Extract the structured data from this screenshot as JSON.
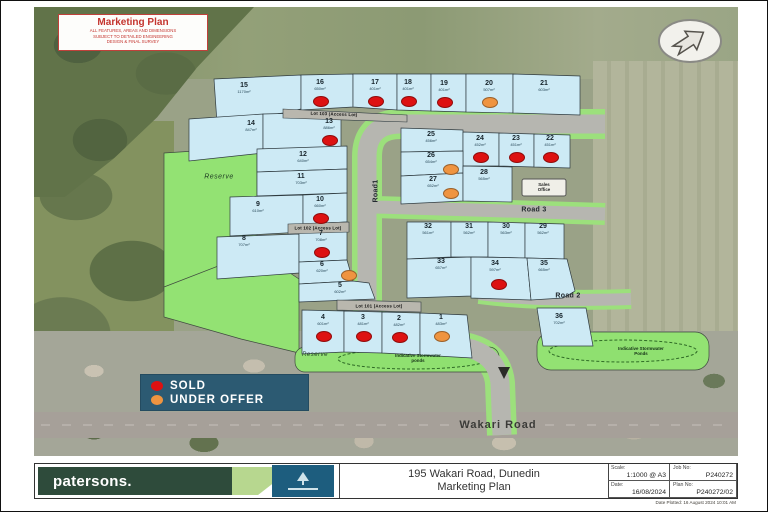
{
  "disclaimer": {
    "title": "Marketing Plan",
    "lines": [
      "ALL FEATURES, AREAS AND DIMENSIONS",
      "SUBJECT TO DETAILED ENGINEERING",
      "DESIGN & FINAL SURVEY"
    ]
  },
  "legend": {
    "items": [
      {
        "label": "SOLD",
        "status": "sold",
        "color": "#dd1111"
      },
      {
        "label": "UNDER OFFER",
        "status": "under offer",
        "color": "#ef9440"
      }
    ],
    "background": "#2c5a72"
  },
  "roads": {
    "road1": "Road1",
    "road2": "Road 2",
    "road3": "Road 3",
    "wakari": "Wakari Road"
  },
  "annotations": {
    "reserve_west": "Reserve",
    "reserve_south": "Reserve",
    "sales_office": [
      "Sales",
      "Office"
    ],
    "stormwater_south": [
      "Indicative Stormwater",
      "ponds"
    ],
    "stormwater_east": [
      "Indicative Stormwater",
      "Ponds"
    ],
    "access_lots": {
      "lot101": "Lot 101 (Access Lot)",
      "lot102": "Lot 102 (Access Lot)",
      "lot103": "Lot 103 (Access Lot)"
    }
  },
  "lots": [
    {
      "id": "1",
      "area": "483m²",
      "status": "under offer"
    },
    {
      "id": "2",
      "area": "482m²",
      "status": "sold"
    },
    {
      "id": "3",
      "area": "481m²",
      "status": "sold"
    },
    {
      "id": "4",
      "area": "601m²",
      "status": "sold"
    },
    {
      "id": "5",
      "area": "602m²",
      "status": "available"
    },
    {
      "id": "6",
      "area": "620m²",
      "status": "under offer"
    },
    {
      "id": "7",
      "area": "708m²",
      "status": "sold"
    },
    {
      "id": "8",
      "area": "707m²",
      "status": "available"
    },
    {
      "id": "9",
      "area": "610m²",
      "status": "available"
    },
    {
      "id": "10",
      "area": "660m²",
      "status": "sold"
    },
    {
      "id": "11",
      "area": "703m²",
      "status": "available"
    },
    {
      "id": "12",
      "area": "640m²",
      "status": "available"
    },
    {
      "id": "13",
      "area": "886m²",
      "status": "sold"
    },
    {
      "id": "14",
      "area": "847m²",
      "status": "available"
    },
    {
      "id": "15",
      "area": "1170m²",
      "status": "available"
    },
    {
      "id": "16",
      "area": "650m²",
      "status": "sold"
    },
    {
      "id": "17",
      "area": "401m²",
      "status": "sold"
    },
    {
      "id": "18",
      "area": "401m²",
      "status": "sold"
    },
    {
      "id": "19",
      "area": "401m²",
      "status": "sold"
    },
    {
      "id": "20",
      "area": "507m²",
      "status": "under offer"
    },
    {
      "id": "21",
      "area": "603m²",
      "status": "available"
    },
    {
      "id": "22",
      "area": "451m²",
      "status": "sold"
    },
    {
      "id": "23",
      "area": "451m²",
      "status": "sold"
    },
    {
      "id": "24",
      "area": "452m²",
      "status": "sold"
    },
    {
      "id": "25",
      "area": "456m²",
      "status": "available"
    },
    {
      "id": "26",
      "area": "654m²",
      "status": "under offer"
    },
    {
      "id": "27",
      "area": "652m²",
      "status": "under offer"
    },
    {
      "id": "28",
      "area": "565m²",
      "status": "available"
    },
    {
      "id": "29",
      "area": "562m²",
      "status": "available"
    },
    {
      "id": "30",
      "area": "563m²",
      "status": "available"
    },
    {
      "id": "31",
      "area": "562m²",
      "status": "available"
    },
    {
      "id": "32",
      "area": "561m²",
      "status": "available"
    },
    {
      "id": "33",
      "area": "657m²",
      "status": "available"
    },
    {
      "id": "34",
      "area": "597m²",
      "status": "sold"
    },
    {
      "id": "35",
      "area": "665m²",
      "status": "available"
    },
    {
      "id": "36",
      "area": "702m²",
      "status": "available"
    }
  ],
  "title_block": {
    "brand": "patersons.",
    "address_line1": "195 Wakari Road, Dunedin",
    "address_line2": "Marketing Plan",
    "scale_label": "Scale:",
    "scale_value": "1:1000 @ A3",
    "job_label": "Job No:",
    "job_value": "P240272",
    "date_label": "Date:",
    "date_value": "16/08/2024",
    "plan_label": "Plan No:",
    "plan_value": "P240272/02",
    "plotted": "Date Plotted: 16 August 2024 10:01 AM"
  }
}
